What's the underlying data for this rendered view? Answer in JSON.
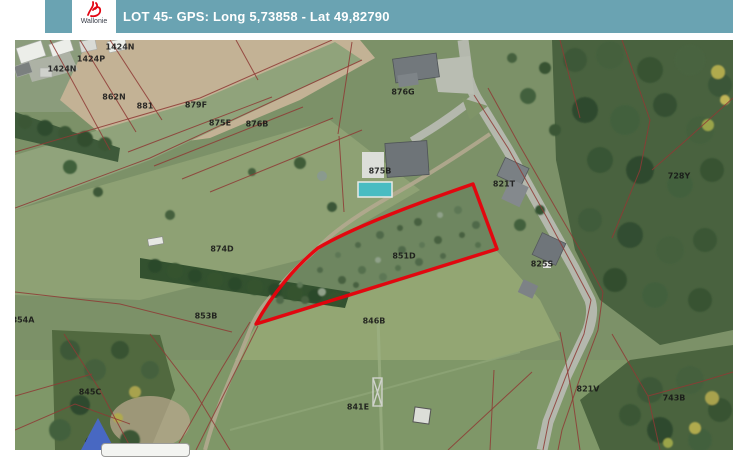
{
  "header": {
    "title": "LOT 45- GPS: Long 5,73858 - Lat 49,82790",
    "logo_text": "Wallonie",
    "bar_color": "#6aa3b2"
  },
  "map": {
    "red_plot": {
      "label": "851D",
      "color": "#e8000b",
      "path": "M256,324 C272,294 296,266 318,248 C352,228 412,205 473,184 L497,249 Z"
    },
    "marker_color": "#4868c2",
    "labels": [
      {
        "text": "1424N",
        "x": 120,
        "y": 47
      },
      {
        "text": "1424P",
        "x": 91,
        "y": 59
      },
      {
        "text": "1424N",
        "x": 62,
        "y": 69
      },
      {
        "text": "862N",
        "x": 114,
        "y": 97
      },
      {
        "text": "881",
        "x": 145,
        "y": 106
      },
      {
        "text": "879F",
        "x": 196,
        "y": 105
      },
      {
        "text": "875E",
        "x": 220,
        "y": 123
      },
      {
        "text": "876B",
        "x": 257,
        "y": 124
      },
      {
        "text": "876G",
        "x": 403,
        "y": 92
      },
      {
        "text": "875B",
        "x": 380,
        "y": 171
      },
      {
        "text": "821T",
        "x": 504,
        "y": 184
      },
      {
        "text": "728Y",
        "x": 679,
        "y": 176
      },
      {
        "text": "874D",
        "x": 222,
        "y": 249
      },
      {
        "text": "851D",
        "x": 404,
        "y": 256
      },
      {
        "text": "825S",
        "x": 542,
        "y": 264
      },
      {
        "text": "846B",
        "x": 374,
        "y": 321
      },
      {
        "text": "854A",
        "x": 23,
        "y": 320
      },
      {
        "text": "853B",
        "x": 206,
        "y": 316
      },
      {
        "text": "845C",
        "x": 90,
        "y": 392
      },
      {
        "text": "841E",
        "x": 358,
        "y": 407
      },
      {
        "text": "821V",
        "x": 588,
        "y": 389
      },
      {
        "text": "743B",
        "x": 674,
        "y": 398
      },
      {
        "text": "443B",
        "x": 96,
        "y": 441
      }
    ],
    "boundary_lines": {
      "color": "#8e3a35",
      "polylines": [
        "15,152 200,98 332,40",
        "15,208 150,158 362,60",
        "50,40 110,150",
        "80,40 136,132",
        "110,40 162,120",
        "236,40 258,80",
        "128,152 272,97",
        "154,166 303,107",
        "182,179 333,118",
        "210,192 362,130",
        "352,42 338,134",
        "339,136 344,212",
        "474,95 508,148 546,216 574,268 591,300",
        "488,88 520,146 558,212 586,260 603,292",
        "591,300 584,334 566,376 549,420 543,450",
        "603,292 598,330 580,378 562,430 558,450",
        "622,40 650,120 640,170 612,238",
        "733,98 684,142 652,170",
        "560,40 580,118",
        "15,292 120,304 232,332",
        "64,334 100,390 132,450",
        "15,396 92,374",
        "150,334 196,394 230,450",
        "196,450 238,366 258,326",
        "175,450 222,368 250,322",
        "448,450 532,372",
        "494,370 490,450",
        "560,332 572,394 580,450",
        "612,334 648,396 660,450",
        "648,396 700,382 733,372",
        "15,430 75,404 130,424"
      ]
    }
  }
}
